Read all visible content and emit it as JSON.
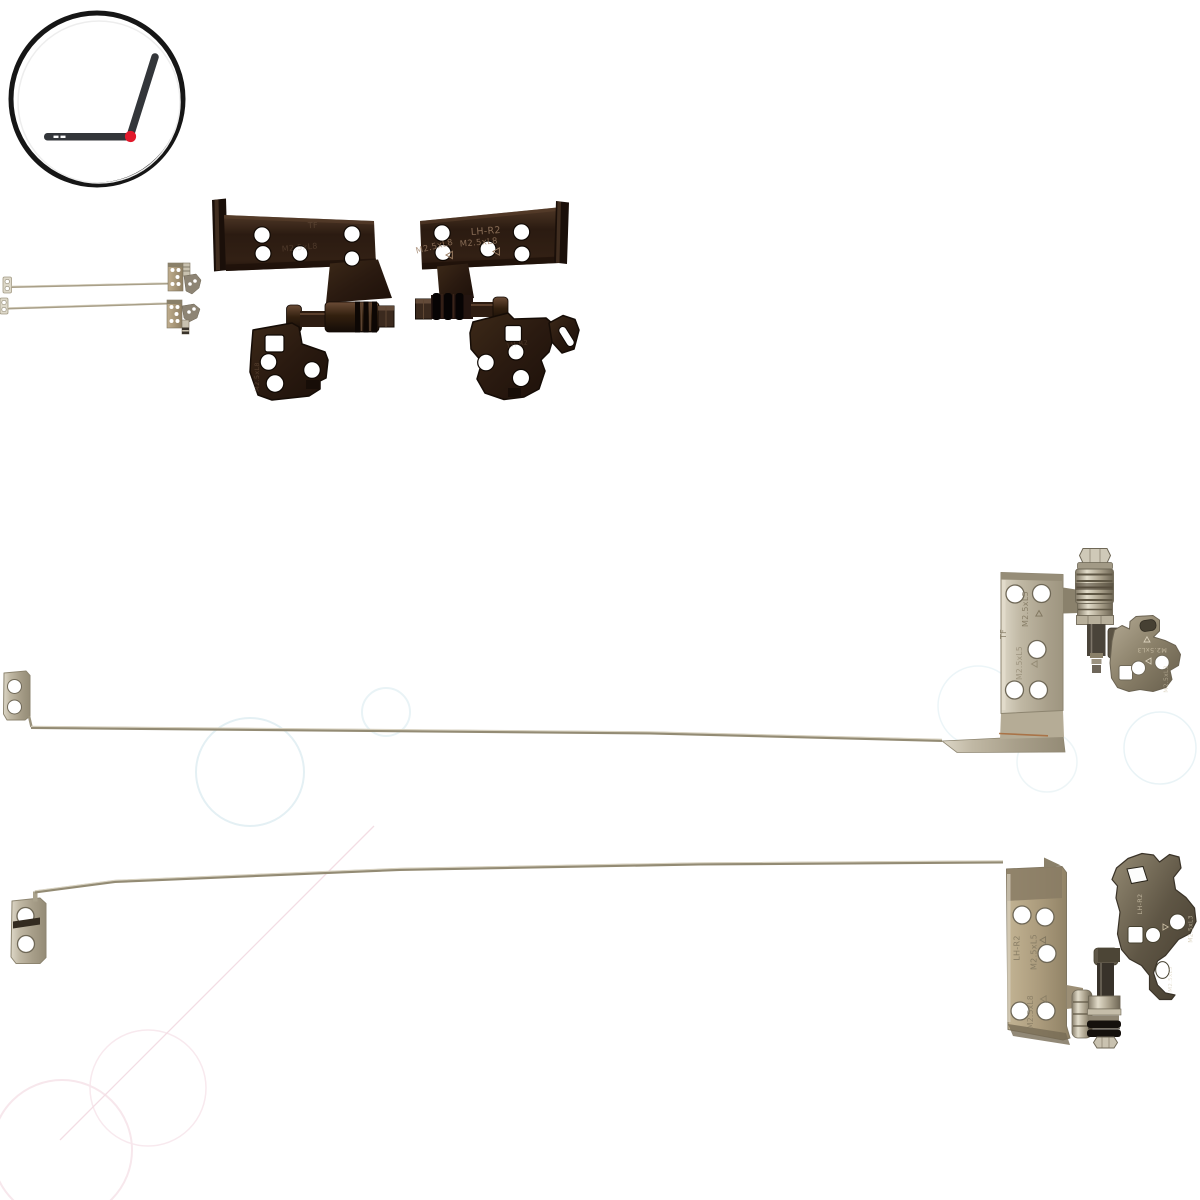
{
  "background": "#ffffff",
  "logo": {
    "ring_color": "#161616",
    "laptop_color": "#33363a",
    "hinge_dot_color": "#e1192b"
  },
  "markings": {
    "model": "LH-R2",
    "screw_l8": "M2.5xL8",
    "screw_l5": "M2.5xL5",
    "screw_l3": "M2.5xL3",
    "stamp_tf": "TF"
  },
  "palette": {
    "dark_hinge_brown": "#2b1b11",
    "steel_light": "#ddd7c7",
    "steel_mid": "#a89f8a",
    "bronze_plate": "#ac9c7d",
    "arm_gray": "#8a8069",
    "stamp_on_dark": "#9a7c63",
    "stamp_on_steel": "#80765f",
    "watermark_blue": "#e4f0f4",
    "watermark_pink": "#f6e3e9"
  }
}
